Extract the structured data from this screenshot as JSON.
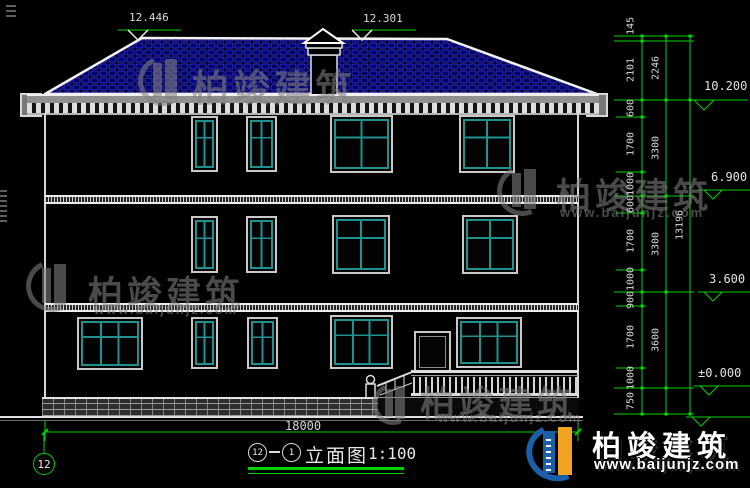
{
  "drawing": {
    "top_markers": [
      {
        "value": "12.446"
      },
      {
        "value": "12.301"
      }
    ],
    "right_dimensions": {
      "col1": [
        "145",
        "2101",
        "600",
        "1700",
        "1000",
        "600",
        "1700",
        "1000",
        "900",
        "1700",
        "1000",
        "750"
      ],
      "col2": [
        "2246",
        "3300",
        "3300",
        "3600"
      ],
      "overall": "13196",
      "levels": [
        "10.200",
        "6.900",
        "3.600",
        "±0.000"
      ]
    },
    "bottom_dimension": "18000",
    "axis_bubble": "12",
    "title": {
      "axis_a": "12",
      "axis_b": "1",
      "name": "立面图",
      "scale": "1:100"
    }
  },
  "watermark": {
    "brand": "柏竣建筑",
    "url": "www.baijunjz.com"
  },
  "logo": {
    "brand": "柏竣建筑",
    "url": "www.baijunjz.com"
  },
  "colors": {
    "dimension_green": "#00d200",
    "roof_blue": "#2b2bd4",
    "window_teal": "#1f9290",
    "logo_blue": "#1b5fa8",
    "logo_orange": "#f0a223"
  }
}
